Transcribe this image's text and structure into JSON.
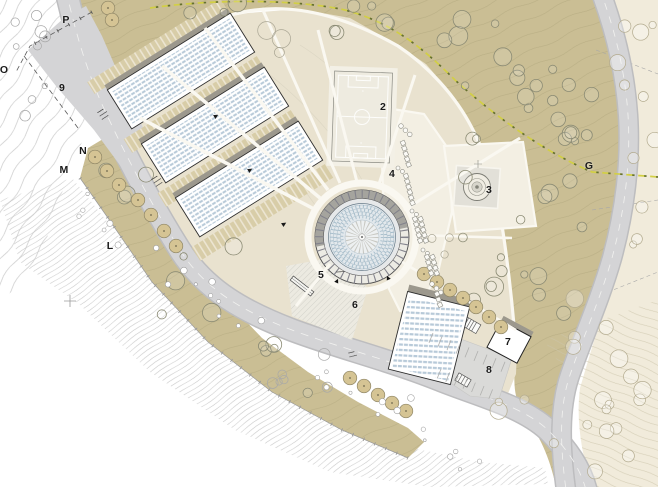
{
  "palette": {
    "olive": "#cabe94",
    "olive_pale": "#d8d2b8",
    "beige": "#e9e2cf",
    "cream_plaza": "#f3efe3",
    "cream_right": "#f1ebdb",
    "road": "#d4d4d6",
    "roof_blue": "#b7c9d8",
    "terrace_tan": "#d8cda8",
    "shadow": "#9c988d",
    "path_white": "#faf8f1",
    "boundary_yellow": "#d2cf45",
    "boundary_dark": "#65702f",
    "ink": "#1a1a1a"
  },
  "plan": {
    "number_labels": [
      {
        "text": "2",
        "x": 383,
        "y": 107
      },
      {
        "text": "3",
        "x": 489,
        "y": 190
      },
      {
        "text": "4",
        "x": 392,
        "y": 174
      },
      {
        "text": "5",
        "x": 321,
        "y": 275
      },
      {
        "text": "6",
        "x": 355,
        "y": 305
      },
      {
        "text": "7",
        "x": 508,
        "y": 342
      },
      {
        "text": "8",
        "x": 489,
        "y": 370
      },
      {
        "text": "9",
        "x": 62,
        "y": 88
      }
    ],
    "letter_labels": [
      {
        "text": "P",
        "x": 66,
        "y": 20
      },
      {
        "text": "O",
        "x": 4,
        "y": 70
      },
      {
        "text": "N",
        "x": 83,
        "y": 151
      },
      {
        "text": "M",
        "x": 64,
        "y": 170
      },
      {
        "text": "L",
        "x": 110,
        "y": 246
      },
      {
        "text": "G",
        "x": 589,
        "y": 166
      }
    ],
    "annotations": [
      {
        "x": 100,
        "y": 111,
        "rot": -33,
        "lines": [
          "▪▪▪▪▪▪▪▪",
          "▪▪▪▪▪▪▪▪▪▪",
          "▪▪▪▪▪▪▪▪▪"
        ]
      },
      {
        "x": 154,
        "y": 178,
        "rot": -33,
        "lines": [
          "▪▪▪▪▪▪▪▪",
          "▪▪▪▪▪▪▪▪▪▪",
          "▪▪▪▪▪▪▪▪▪"
        ]
      },
      {
        "x": 336,
        "y": 271,
        "rot": -4,
        "lines": [
          "▪▪▪▪▪▪▪▪▪▪"
        ]
      },
      {
        "x": 349,
        "y": 352,
        "rot": -14,
        "lines": [
          "▪▪▪▪▪▪▪",
          "▪▪▪▪▪▪▪▪▪"
        ]
      }
    ]
  }
}
